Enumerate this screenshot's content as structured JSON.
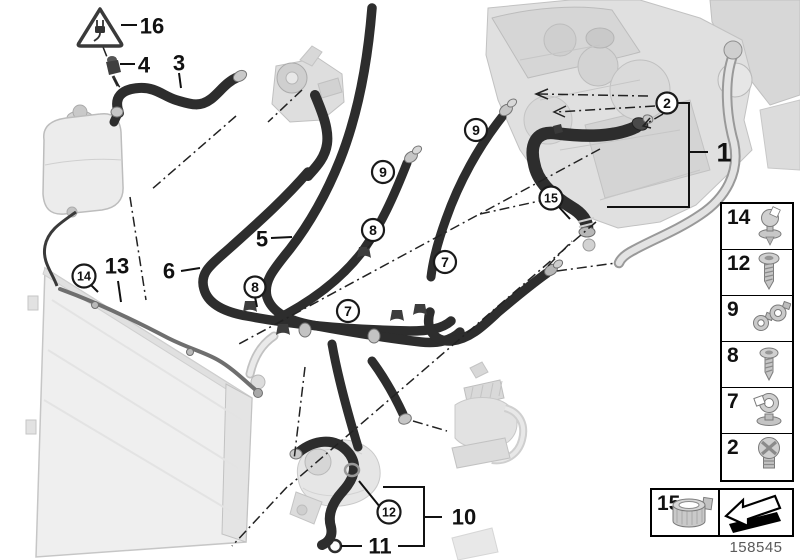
{
  "diagram": {
    "warning": {
      "symbol": "electrical-plug-warning-triangle"
    },
    "callouts": {
      "c1": "1",
      "c2": "2",
      "c3": "3",
      "c4": "4",
      "c5": "5",
      "c6": "6",
      "c7a": "7",
      "c7b": "7",
      "c8a": "8",
      "c8b": "8",
      "c9a": "9",
      "c9b": "9",
      "c10": "10",
      "c11": "11",
      "c12": "12",
      "c13": "13",
      "c14": "14",
      "c15": "15",
      "c16": "16"
    }
  },
  "legend": {
    "rows": [
      {
        "number": "14",
        "icon": "expanding-rivet-clip-icon"
      },
      {
        "number": "12",
        "icon": "pan-head-screw-icon"
      },
      {
        "number": "9",
        "icon": "hose-spring-clamps-icon"
      },
      {
        "number": "8",
        "icon": "self-tapping-screw-icon"
      },
      {
        "number": "7",
        "icon": "hose-clamp-holder-icon"
      },
      {
        "number": "2",
        "icon": "cross-head-screw-icon"
      }
    ],
    "bottom": {
      "number": "15",
      "icon": "band-clamp-icon"
    },
    "arrow_icon": "continue-arrow-icon"
  },
  "footer": {
    "part_number": "158545"
  },
  "colors": {
    "hose": "#2d2d2d",
    "ghost_part": "#e0e0e0",
    "line": "#1a1a1a",
    "part_number_text": "#5a5a5a"
  }
}
